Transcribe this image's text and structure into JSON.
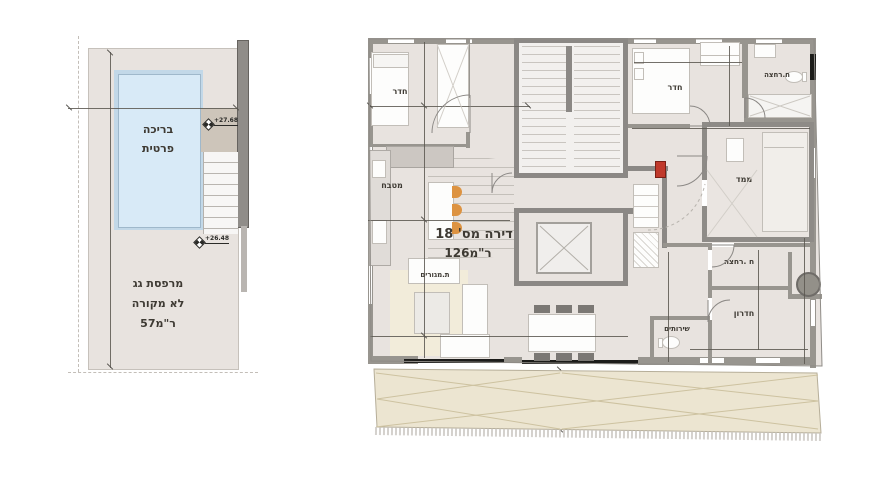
{
  "left_plan": {
    "pool": [
      "בריכה",
      "פרטית"
    ],
    "terrace": [
      "מרפסת גג",
      "לא מקורה",
      "57מ‎\"ר‎"
    ],
    "elevation_upper": "+27.68",
    "elevation_lower": "+26.48"
  },
  "main_plan": {
    "title": "דירה מס' 18",
    "area": "126מ‎\"ר‎",
    "rooms": {
      "bedroom_left": "חדר",
      "bedroom_right": "חדר",
      "kitchen": "מטבח",
      "living_room": "ת.מגורים",
      "bathroom_top": "ח.רחצה",
      "safe_room": "ממד",
      "bathroom_mid": "ח .רחצה",
      "small_room": "חדרון",
      "toilet": "שירותים"
    },
    "terrace": {
      "label": "מרפסת גג לא מקורה",
      "area": "25מ‎\"ר‎"
    }
  },
  "colors": {
    "floor": "#e8e3df",
    "wall": "#98958f",
    "core_wall": "#8b8885",
    "pool": "#d8eaf7",
    "terrace": "#ece5d1",
    "rug": "#f2ecda",
    "stool_orange": "#dd9341",
    "fire_cabinet_red": "#c0392b",
    "boiler_gray": "#939089"
  }
}
